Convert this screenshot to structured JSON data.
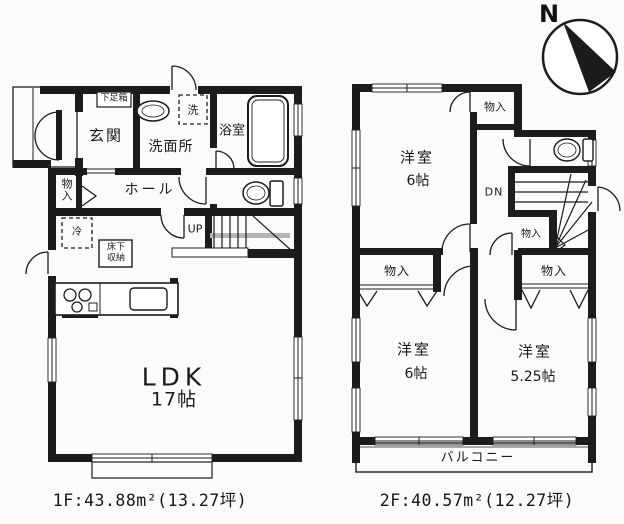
{
  "colors": {
    "ink": "#1c1c1c",
    "paper": "#fbfbf9"
  },
  "compass": {
    "north_label": "N"
  },
  "floor1": {
    "caption": "1F:43.88m²(13.27坪)",
    "labels": {
      "shoe_cabinet": "下足箱",
      "entrance": "玄関",
      "washer": "洗",
      "washroom": "洗面所",
      "bathroom": "浴室",
      "closet": "物入",
      "hall": "ホール",
      "stairs_up": "UP",
      "refrigerator": "冷",
      "underfloor_storage_line1": "床下",
      "underfloor_storage_line2": "収納",
      "ldk": "LDK",
      "ldk_size": "17帖"
    }
  },
  "floor2": {
    "caption": "2F:40.57m²(12.27坪)",
    "labels": {
      "room_top": "洋室",
      "room_top_size": "6帖",
      "closet_top": "物入",
      "stairs_down": "DN",
      "closet_stairs": "物入",
      "closet_left": "物入",
      "closet_right": "物入",
      "room_bottom_left": "洋室",
      "room_bottom_left_size": "6帖",
      "room_bottom_right": "洋室",
      "room_bottom_right_size": "5.25帖",
      "balcony": "バルコニー"
    }
  }
}
